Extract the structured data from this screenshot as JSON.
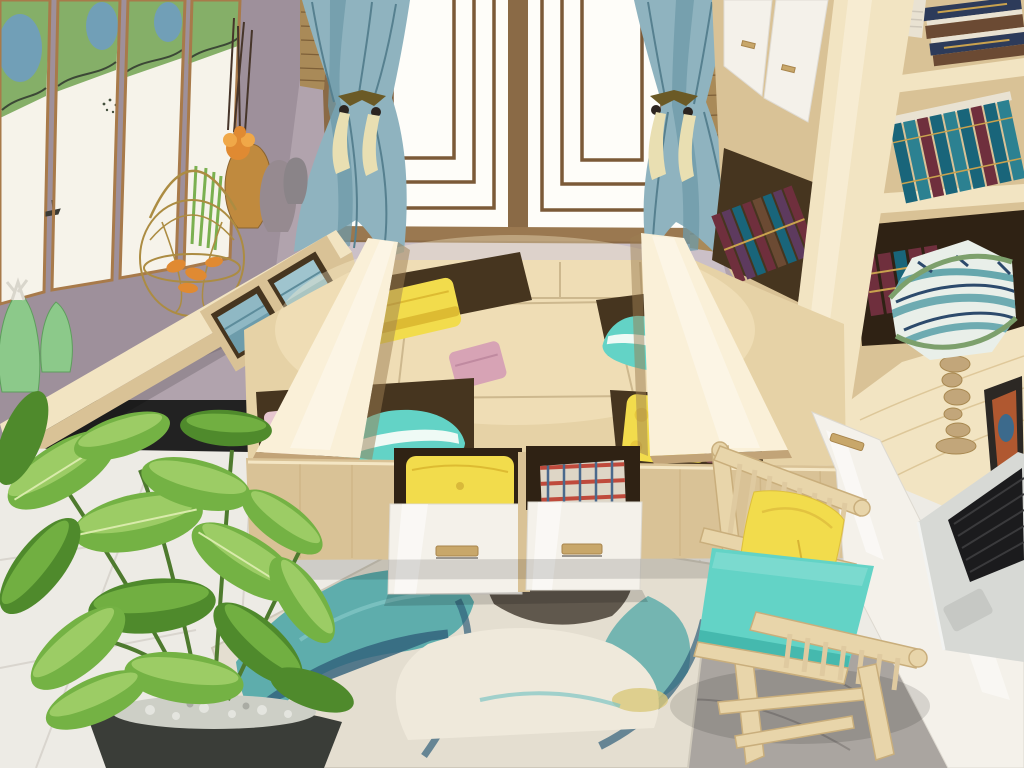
{
  "scene": {
    "type": "interior-photo",
    "room": "tatami bedroom with storage platform bed and study corner",
    "inventory": [
      "framed ink-wash painting panels on mauve wall",
      "lattice window with two panes and blue tie-back curtains",
      "bamboo blinds",
      "light-wood wall shelf with teal storage boxes, vases, gold birdcage, green ceramic figurines",
      "tall light-wood bookcase with teal and maroon books, white cabinet doors",
      "platform tatami bed with two lifted storage lids",
      "storage compartments holding yellow, teal-striped and floral pillows, pink and maroon towels",
      "two pulled-out white drawers with yellow cushion and plaid clothes",
      "desk nook with patterned table lamp, picture frame, laptop, white glossy drawers",
      "pale wood chair with teal seat cushion and yellow pillow",
      "large green potted plant with pebbles",
      "teal abstract marbled rug on white marble tile floor"
    ]
  },
  "colors": {
    "wall": "#b1a3ad",
    "wallDark": "#9e909b",
    "wallLight": "#cbc0c8",
    "window": "#fefdf9",
    "lattice": "#7b5a38",
    "frame": "#8a6a46",
    "blind": "#a98a58",
    "blindLine": "#7d5f38",
    "curtain": "#8fb3bf",
    "curtainShadow": "#6e99a8",
    "curtainDeep": "#56808f",
    "tassel": "#e9dfb2",
    "clasp": "#6b5a26",
    "wood": "#e6d2a6",
    "woodLight": "#f2e4c2",
    "woodBright": "#faf0d8",
    "woodMid": "#d9c296",
    "woodDark": "#c2a478",
    "woodShadow": "#9c7d52",
    "recess": "#46351f",
    "recessDark": "#2f2214",
    "white": "#f4f1ea",
    "handle": "#c8a76a",
    "bookTeal": "#19657a",
    "bookTeal2": "#2c8191",
    "bookMaroon": "#6f2f3d",
    "bookPurple": "#5d3a5e",
    "bookNavy": "#2d3b5a",
    "bookBrown": "#6b4a33",
    "pageCream": "#e9e2d2",
    "goldTrim": "#c9a24e",
    "pillowTeal": "#63d3c6",
    "pillowTealDeep": "#3db3a8",
    "stripeWhite": "#effaf5",
    "pillowYellow": "#f2dc4c",
    "pillowYellowDeep": "#ddbb32",
    "towelPink": "#d7a3b5",
    "towelPinkLight": "#e7c6cf",
    "towelMaroon": "#7b4850",
    "towelSlate": "#5d7f8d",
    "plaidBase": "#ded6c6",
    "plaidRed": "#bf4a3c",
    "plaidBlue": "#4a698c",
    "marble": "#edebe5",
    "marbleVein": "#d7d3cc",
    "grayFloor": "#aaa5a0",
    "grayFloorDark": "#918c88",
    "rugBase": "#e4ded0",
    "rugTeal": "#4fa7a7",
    "rugNavy": "#31607b",
    "rugCream": "#efe9db",
    "rugYellow": "#d9c87b",
    "rugDark": "#554c41",
    "leaf": "#74b244",
    "leafLight": "#a6d26e",
    "leafDark": "#4f8a2c",
    "leafVein": "#d9ebab",
    "pot": "#3a3d38",
    "pebble": "#cdcfc6",
    "greenCeramic": "#8cc98a",
    "whiteCeramic": "#f1efe7",
    "amber": "#c08a3e",
    "orange": "#e08a32",
    "cage": "#ac8c42",
    "shadeBase": "#e9efe9",
    "shadeTeal": "#4f9aa2",
    "shadeNavy": "#2c4a6c",
    "shadeTrim": "#7da06c",
    "lampWood": "#c2a67a",
    "silver": "#d7d9d5",
    "laptopKey": "#1b1b1d",
    "chairWood": "#e8d5aa",
    "chairEdge": "#c9ae7c",
    "copper": "#a87a4a",
    "paintGreen": "#85af68",
    "paintBlue": "#6d9cc6",
    "ink": "#3c4836",
    "paper": "#f6f3ea",
    "lightGlow": "#fff3d2"
  }
}
